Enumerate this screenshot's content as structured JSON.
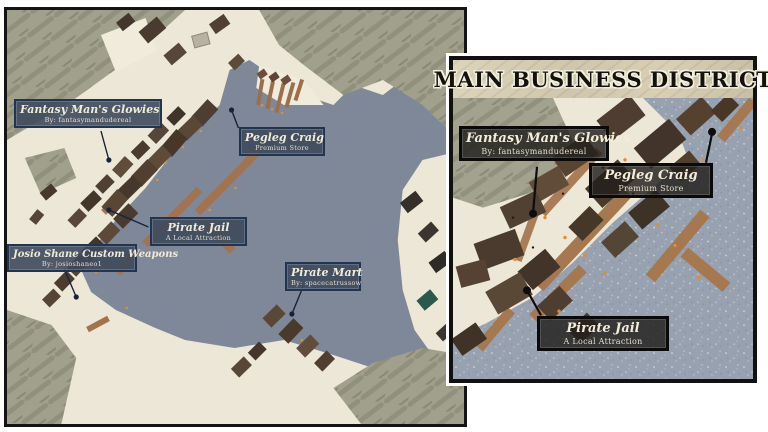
{
  "left_map": {
    "labels": {
      "fantasy": {
        "title": "Fantasy Man's Glowies",
        "subtitle": "By: fantasymandudereal"
      },
      "pegleg": {
        "title": "Pegleg Craig",
        "subtitle": "Premium Store"
      },
      "jail": {
        "title": "Pirate Jail",
        "subtitle": "A Local Attraction"
      },
      "josio": {
        "title": "Josio Shane Custom Weapons",
        "subtitle": "By: josioshaneo1"
      },
      "mart": {
        "title": "Pirate Mart",
        "subtitle": "By: spacecatrussow"
      }
    }
  },
  "inset": {
    "title": "MAIN BUSINESS DISTRICT",
    "labels": {
      "fantasy": {
        "title": "Fantasy Man's Glowies",
        "subtitle": "By: fantasymandudereal"
      },
      "pegleg": {
        "title": "Pegleg Craig",
        "subtitle": "Premium Store"
      },
      "jail": {
        "title": "Pirate Jail",
        "subtitle": "A Local Attraction"
      }
    }
  },
  "colors": {
    "water": "#7e8898",
    "inset_water": "#97a1b0",
    "land": "#ece7d6",
    "rock": "#9f9f8c",
    "dock": "#a2734e",
    "label_bg": "#3e495c",
    "label_border": "#223550",
    "inset_label_border": "#0a0a0a",
    "light_dot": "#e0913f"
  }
}
